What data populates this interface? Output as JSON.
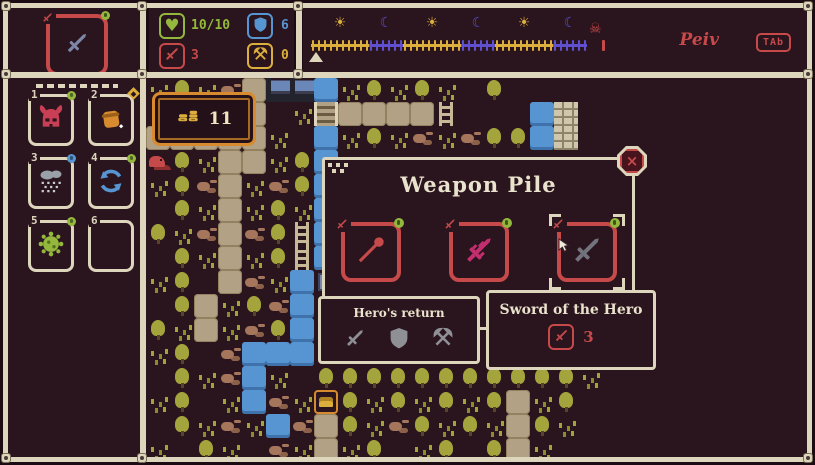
{
  "colors": {
    "cream": "#ded5bd",
    "red": "#c64a4a",
    "green": "#93b83d",
    "blue": "#5795d2",
    "yellow": "#dcae3c",
    "purple": "#6050cf",
    "olive": "#a3a43c",
    "tan": "#b3a185",
    "rock": "#a5765c",
    "magenta": "#c22e6e",
    "grey": "#8f8f96",
    "orange": "#d78a2e",
    "panel": "#2a141d"
  },
  "equipped_slot": {
    "item": "dagger"
  },
  "stats": {
    "health": {
      "icon": "heart",
      "value": "10/10",
      "color": "#93b83d"
    },
    "shield": {
      "icon": "shield",
      "value": "6",
      "color": "#5795d2"
    },
    "attack": {
      "icon": "sword",
      "value": "3",
      "color": "#c64a4a"
    },
    "axes": {
      "icon": "axes",
      "value": "0",
      "color": "#dcae3c"
    }
  },
  "timeline": {
    "segments": [
      {
        "period": "day",
        "ticks": 10
      },
      {
        "period": "night",
        "ticks": 6
      },
      {
        "period": "day",
        "ticks": 10
      },
      {
        "period": "night",
        "ticks": 6
      },
      {
        "period": "day",
        "ticks": 10
      },
      {
        "period": "night",
        "ticks": 6
      }
    ],
    "end_icon": "skull",
    "signature": "Peiv",
    "key_hint": "TAb"
  },
  "sidebar": {
    "slots": [
      {
        "number": "1",
        "item": "horned-helmet",
        "badge": "green-dot"
      },
      {
        "number": "2",
        "item": "loot-pouch",
        "badge": "yellow-diamond"
      },
      {
        "number": "3",
        "item": "rain-cloud",
        "badge": "blue-dot"
      },
      {
        "number": "4",
        "item": "cycle-arrows",
        "badge": "green-dot"
      },
      {
        "number": "5",
        "item": "spore",
        "badge": "green-dot"
      },
      {
        "number": "6",
        "item": "",
        "badge": ""
      }
    ]
  },
  "map": {
    "coin_count": "11",
    "legend": {
      ".": "ground",
      "t": "tree",
      "g": "sprout",
      "r": "rocks",
      "p": "path",
      "w": "water",
      "h": "house",
      "b": "bridge",
      "l": "ladder",
      "c": "chest",
      "m": "red-creature",
      "s": "signpost",
      "k": "bricks"
    },
    "tiles": [
      "gtgrphhwgtgtg.t.............",
      ".t..p.gbppppl...wk..........",
      "pppppg.wgtgrgrttwk..........",
      "mtgppgtw....................",
      "gtrpgrtw....................",
      ".tgpgtgw....................",
      "tgrprtlw....................",
      ".tgpgtlw....................",
      "gt.prgws....................",
      ".tpgtrwg....................",
      "tgpgrtwg....................",
      "gt.rwww.....................",
      ".tgrwg.tttttttttttg.........",
      "gt.gwrgctgtgtgtpgt..........",
      ".tgrgwrptgrtgtgptg..........",
      "g.tg.rgpgt.gt.tpg..........."
    ]
  },
  "dialog": {
    "title": "Weapon Pile",
    "close_glyph": "×",
    "slots": [
      {
        "item": "spear",
        "selected": false
      },
      {
        "item": "ornate-sword",
        "selected": false
      },
      {
        "item": "hero-sword",
        "selected": true,
        "cursor": true
      }
    ]
  },
  "tooltips": {
    "loadout": {
      "title": "Hero's return",
      "icons": [
        "sword",
        "shield",
        "axes"
      ]
    },
    "item": {
      "title": "Sword of the Hero",
      "stat_icon": "sword",
      "stat_value": "3"
    }
  }
}
